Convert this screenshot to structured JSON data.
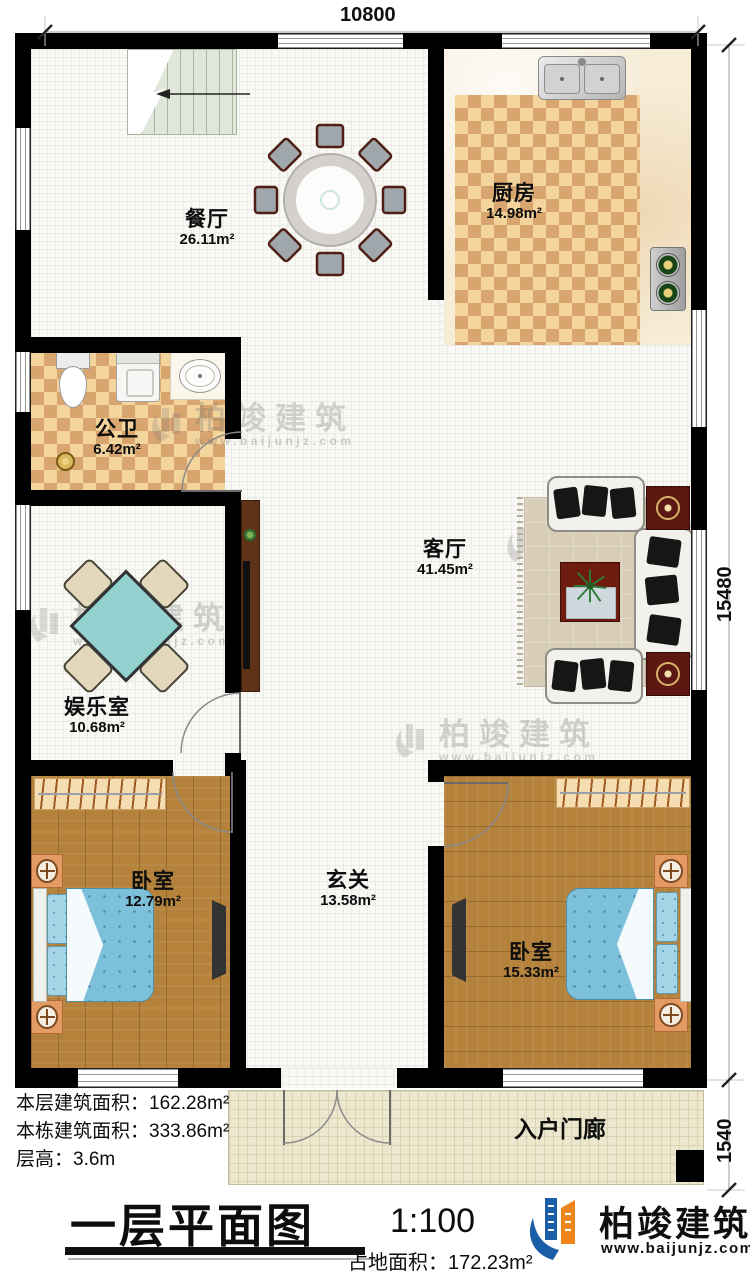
{
  "title_block": {
    "title": "一层平面图",
    "scale": "1:100",
    "land_area_label": "占地面积：",
    "land_area_value": "172.23m²"
  },
  "stats": [
    {
      "label": "本层建筑面积：",
      "value": "162.28m²"
    },
    {
      "label": "本栋建筑面积：",
      "value": "333.86m²"
    },
    {
      "label": "层高：",
      "value": "3.6m"
    }
  ],
  "dimensions": {
    "width_top": "10800",
    "height_right": "15480",
    "porch_height": "1540"
  },
  "rooms": {
    "dining": {
      "name": "餐厅",
      "area": "26.11m²"
    },
    "kitchen": {
      "name": "厨房",
      "area": "14.98m²"
    },
    "bathroom": {
      "name": "公卫",
      "area": "6.42m²"
    },
    "living": {
      "name": "客厅",
      "area": "41.45m²"
    },
    "entertainment": {
      "name": "娱乐室",
      "area": "10.68m²"
    },
    "bedroom_left": {
      "name": "卧室",
      "area": "12.79m²"
    },
    "foyer": {
      "name": "玄关",
      "area": "13.58m²"
    },
    "bedroom_right": {
      "name": "卧室",
      "area": "15.33m²"
    },
    "porch": {
      "name": "入户门廊"
    }
  },
  "branding": {
    "company": "柏竣建筑",
    "website": "www.baijunjz.com"
  },
  "watermark": {
    "company": "柏竣建筑",
    "website": "www.baijunjz.com"
  },
  "colors": {
    "wall": "#000000",
    "checker_dark": "#d8a56f",
    "checker_light": "#f3d49c",
    "wood": "#b5823c",
    "bed_blue": "#7cc0da",
    "game_table": "#93d2d0",
    "accent_red": "#5c1710",
    "brand_blue": "#1b5ea8",
    "brand_orange": "#f08519"
  }
}
